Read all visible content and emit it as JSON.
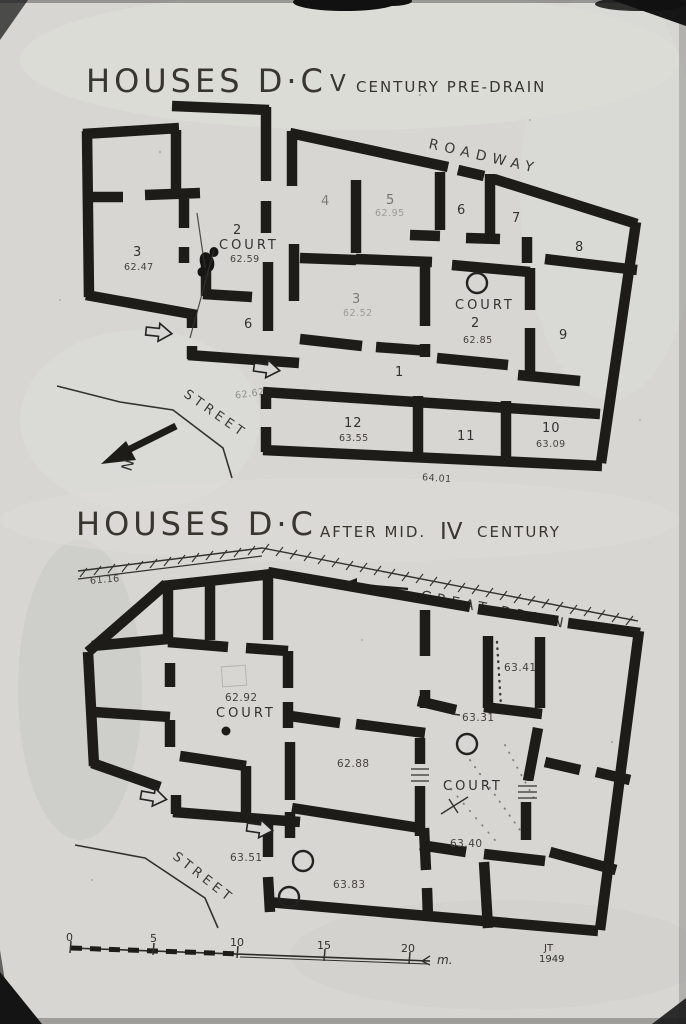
{
  "top_plan": {
    "title": "HOUSES D·C",
    "era_numeral": "V",
    "era_text": "CENTURY PRE-DRAIN",
    "roadway_label": "ROADWAY",
    "street_label": "STREET",
    "north_label": "N",
    "house_d": {
      "room3": "3",
      "room3_elev": "62.47",
      "court_no": "2",
      "court_label": "COURT",
      "court_elev": "62.59",
      "room6": "6"
    },
    "house_c": {
      "room4": "4",
      "room5": "5",
      "room5_elev": "62.95",
      "room6": "6",
      "room7": "7",
      "room8": "8",
      "room3": "3",
      "room3_elev": "62.52",
      "court_label": "COURT",
      "court_no": "2",
      "court_elev": "62.85",
      "room9": "9",
      "room1": "1",
      "room12": "12",
      "room12_elev": "63.55",
      "room11": "11",
      "room10": "10",
      "room10_elev": "63.09",
      "south_elev": "64.01",
      "entry_elev": "62.62"
    }
  },
  "bottom_plan": {
    "title": "HOUSES D·C",
    "era_prefix": "AFTER MID.",
    "era_numeral": "IV",
    "era_suffix": "CENTURY",
    "drain_label": "GREAT DRAIN",
    "street_label": "STREET",
    "drain_elev": "61.16",
    "house_d": {
      "court_elev": "62.92",
      "court_label": "COURT"
    },
    "house_c": {
      "ne_elev": "63.41",
      "mid_elev": "63.31",
      "west_elev": "62.88",
      "court_label": "COURT",
      "court_elev": "63.40",
      "entry_elev": "63.51",
      "south_elev": "63.83"
    }
  },
  "scale_bar": {
    "ticks": [
      "0",
      "5",
      "10",
      "15",
      "20"
    ],
    "unit": "m.",
    "initials": "JT",
    "year": "1949"
  }
}
